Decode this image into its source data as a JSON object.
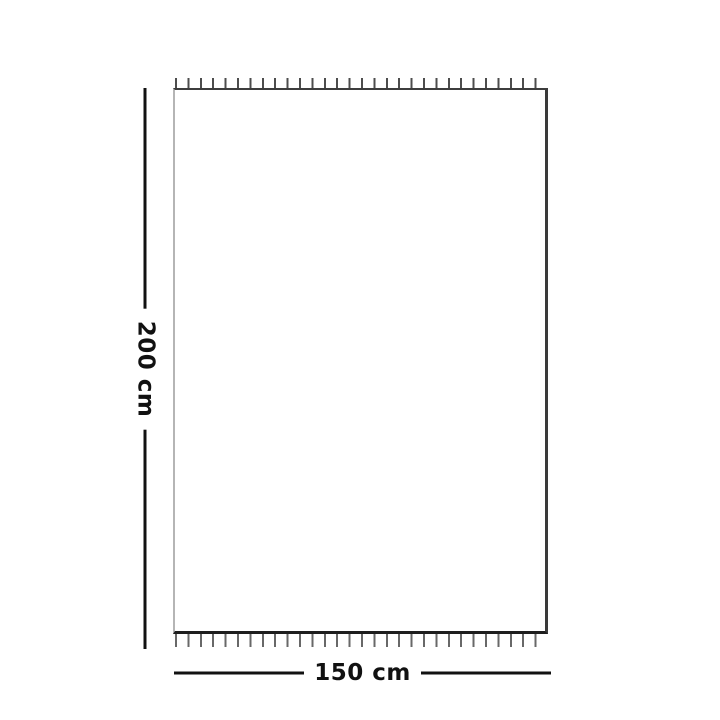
{
  "diagram": {
    "type": "product-dimension-diagram",
    "shape": "rectangle-with-fringed-top-and-bottom-edges",
    "dimensions": {
      "height": {
        "label": "200 cm",
        "orientation": "vertical"
      },
      "width": {
        "label": "150 cm",
        "orientation": "horizontal"
      }
    }
  },
  "colors": {
    "background": "#ffffff",
    "dimension_line": "#111111",
    "label_text": "#111111",
    "outline_top": "#3d3d3d",
    "outline_right": "#3a3a3a",
    "outline_bottom": "#1e1e1e",
    "outline_left": "#b5b5b5",
    "fringe": "#4d4d4d"
  }
}
